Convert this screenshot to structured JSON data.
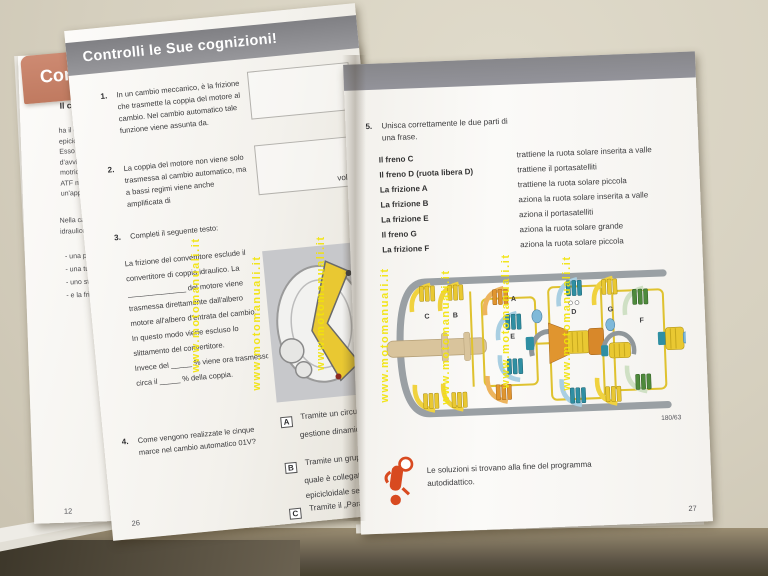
{
  "banner": {
    "title": "Controlli le Sue cognizioni!"
  },
  "tab": {
    "label": "Conv"
  },
  "under_page": {
    "heading": "Il converti",
    "para1": [
      "ha il compito",
      "epicicloidale l",
      "Esso deve fun",
      "d'avviamento",
      "motrice. La s",
      "ATF mantenu",
      "un'apposita p"
    ],
    "para2": [
      "Nella carcass",
      "idraulico vi sc"
    ],
    "bullets": [
      "- una pom",
      "- una turb",
      "- uno stat",
      "- e la frizio"
    ],
    "page_number": "12"
  },
  "left_page": {
    "q1": {
      "num": "1.",
      "text": "In un cambio meccanico, è la frizione che trasmette la coppia del motore al cambio. Nel cambio automatico tale funzione viene assunta da."
    },
    "q2": {
      "num": "2.",
      "text": "La coppia del motore non viene solo trasmessa al cambio automatico, ma a bassi regimi viene anche amplificata di",
      "box_label": "volte."
    },
    "q3": {
      "num": "3.",
      "intro": "Completi il seguente testo:",
      "lines": [
        "La frizione del convertitore esclude il",
        "convertitore di coppia idraulico. La",
        "______________ del motore viene",
        "trasmessa direttamente dall'albero",
        "motore all'albero d'entrata del cambio.",
        "In questo modo viene escluso lo",
        "slittamento del convertitore.",
        "Invece del _____ % viene ora trasmesso",
        "circa il _____ % della coppia."
      ]
    },
    "q4": {
      "num": "4.",
      "text": "Come vengono realizzate le cinque marce nel cambio automatico 01V?",
      "answers": {
        "A": {
          "key": "A",
          "lines": [
            "Tramite un circuito speciale del prog",
            "gestione dinamica delle selezioni DS"
          ]
        },
        "B": {
          "key": "B",
          "lines": [
            "Tramite un gruppo epicicloidale Rav",
            "quale è collegato in serie un rotism",
            "epicicloidale semplice."
          ]
        },
        "C": {
          "key": "C",
          "lines": [
            "Tramite il „Parallel-Axis-Torsen\"."
          ]
        }
      }
    },
    "page_number": "26"
  },
  "right_page": {
    "q5": {
      "num": "5.",
      "text": "Unisca correttamente le due parti di una frase.",
      "left_items": [
        "Il freno C",
        "Il freno D (ruota libera D)",
        "La frizione A",
        "La frizione B",
        "La frizione E",
        "Il freno G",
        "La frizione F"
      ],
      "right_items": [
        "trattiene la ruota solare inserita a valle",
        "trattiene il portasatelliti",
        "trattiene la ruota solare piccola",
        "aziona la ruota solare inserita a valle",
        "aziona il portasatelliti",
        "aziona la ruota solare grande",
        "aziona la ruota solare piccola"
      ]
    },
    "diagram": {
      "labels": {
        "c": "C",
        "b": "B",
        "a": "A",
        "e": "E",
        "d": "D",
        "g": "G",
        "f": "F"
      },
      "caption": "180/63"
    },
    "note": "Le soluzioni si trovano alla fine del programma autodidattico.",
    "page_number": "27"
  },
  "watermark": {
    "text": "www.motomanuali.it"
  }
}
